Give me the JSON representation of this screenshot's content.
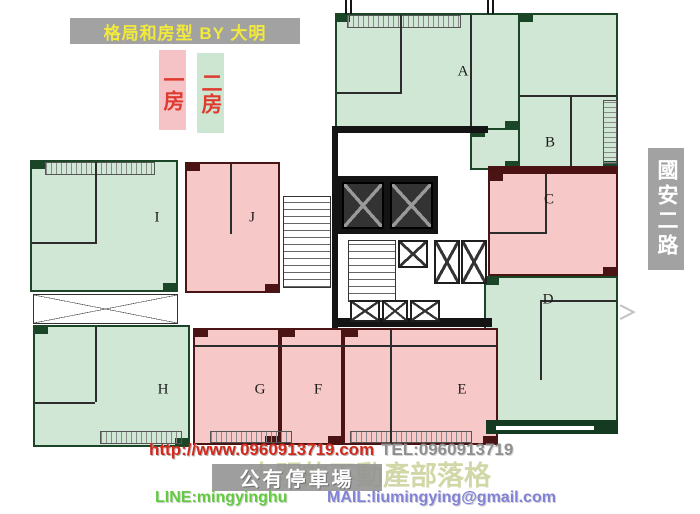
{
  "banner": {
    "title": "格局和房型 BY 大明"
  },
  "legend": {
    "items": [
      {
        "label": "一房",
        "fill": "#f5c3c6",
        "text_color": "#e03a2f"
      },
      {
        "label": "二房",
        "fill": "#cde6d2",
        "text_color": "#e03a2f"
      }
    ]
  },
  "road_sign": {
    "label": "國安二路"
  },
  "plan": {
    "unit_types": {
      "one_bed": {
        "fill": "#f6c8c8",
        "wall": "#4a1414"
      },
      "two_bed": {
        "fill": "#cfe7d4",
        "wall": "#1a4527"
      }
    },
    "arrow_glyph": "＞",
    "units": [
      {
        "id": "unit-a",
        "label": "A",
        "type": "two_bed",
        "rects": [
          [
            335,
            13,
            185,
            117
          ]
        ],
        "label_pos": [
          463,
          72
        ]
      },
      {
        "id": "unit-b",
        "label": "B",
        "type": "two_bed",
        "rects": [
          [
            518,
            13,
            100,
            157
          ],
          [
            470,
            128,
            50,
            42
          ]
        ],
        "label_pos": [
          550,
          143
        ]
      },
      {
        "id": "unit-c",
        "label": "C",
        "type": "one_bed",
        "rects": [
          [
            488,
            172,
            130,
            104
          ]
        ],
        "label_pos": [
          549,
          200
        ]
      },
      {
        "id": "unit-d",
        "label": "D",
        "type": "two_bed",
        "rects": [
          [
            484,
            276,
            134,
            158
          ]
        ],
        "label_pos": [
          548,
          300
        ]
      },
      {
        "id": "unit-e",
        "label": "E",
        "type": "one_bed",
        "rects": [
          [
            343,
            328,
            155,
            117
          ]
        ],
        "label_pos": [
          462,
          390
        ]
      },
      {
        "id": "unit-f",
        "label": "F",
        "type": "one_bed",
        "rects": [
          [
            280,
            328,
            63,
            117
          ]
        ],
        "label_pos": [
          318,
          390
        ]
      },
      {
        "id": "unit-g",
        "label": "G",
        "type": "one_bed",
        "rects": [
          [
            193,
            328,
            87,
            117
          ]
        ],
        "label_pos": [
          260,
          390
        ]
      },
      {
        "id": "unit-h",
        "label": "H",
        "type": "two_bed",
        "rects": [
          [
            33,
            325,
            157,
            122
          ]
        ],
        "label_pos": [
          163,
          390
        ]
      },
      {
        "id": "unit-i",
        "label": "I",
        "type": "two_bed",
        "rects": [
          [
            30,
            160,
            148,
            132
          ]
        ],
        "label_pos": [
          157,
          218
        ]
      },
      {
        "id": "unit-j",
        "label": "J",
        "type": "one_bed",
        "rects": [
          [
            185,
            162,
            95,
            131
          ]
        ],
        "label_pos": [
          252,
          218
        ]
      }
    ]
  },
  "footer": {
    "url": "http://www.0960913719.com",
    "tel": "TEL:0960913719",
    "blog_watermark": "大明的不動產部落格",
    "parking": "公有停車場",
    "line": "LINE:mingyinghu",
    "mail": "MAIL:liumingying@gmail.com"
  }
}
